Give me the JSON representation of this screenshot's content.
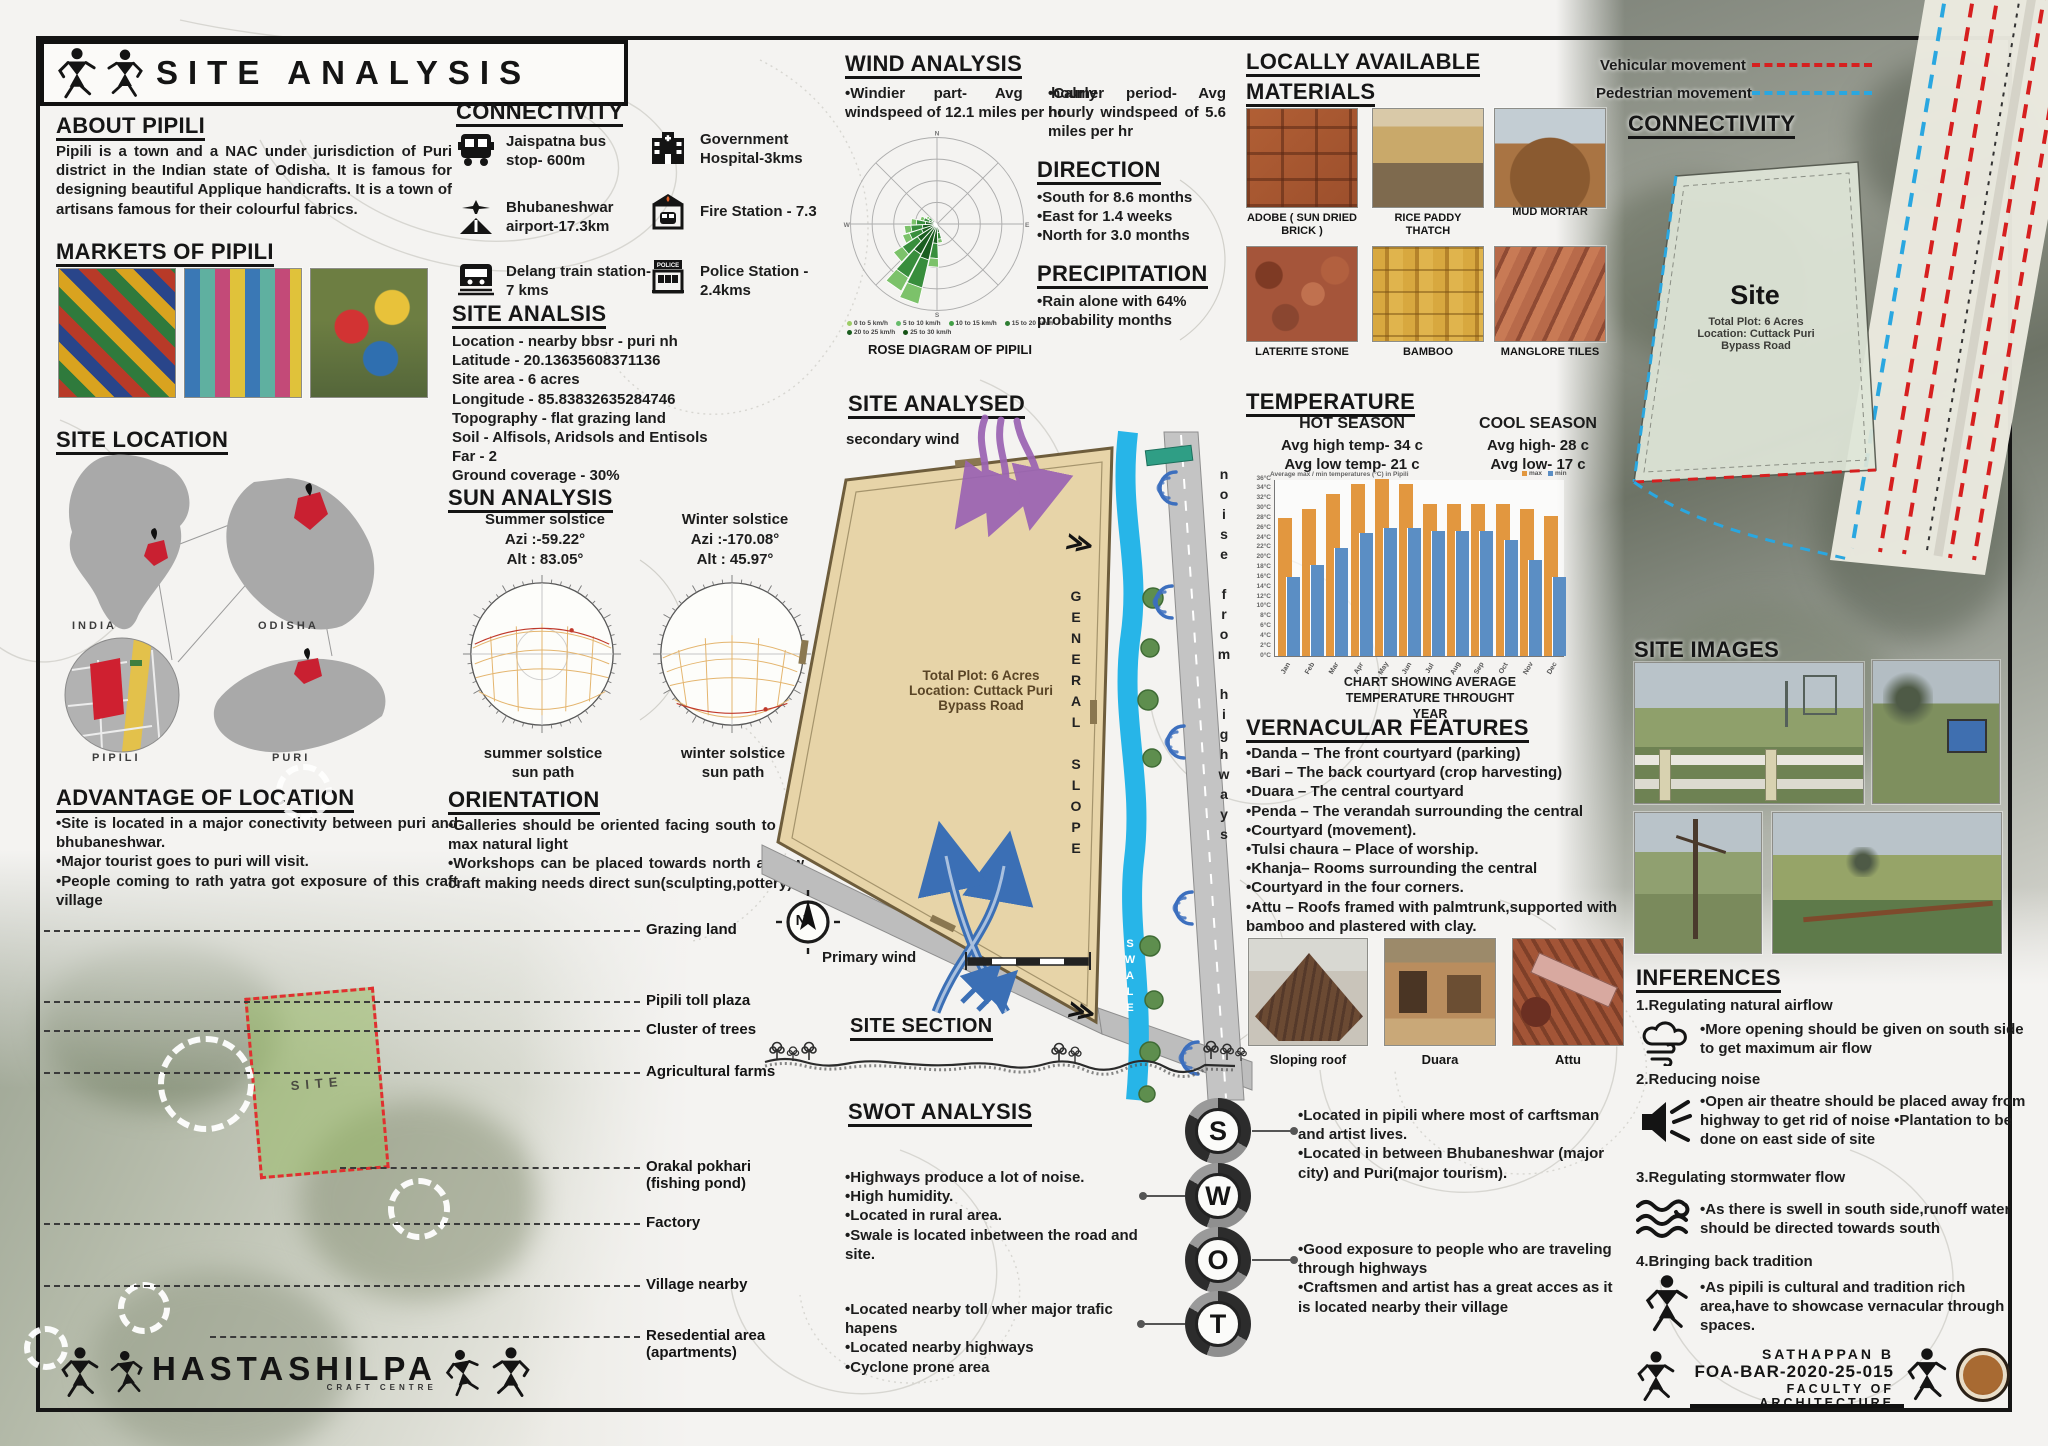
{
  "title": {
    "text": "SITE ANALYSIS"
  },
  "about": {
    "heading": "ABOUT PIPILI",
    "text": "Pipili is a town and a NAC under jurisdiction of Puri district in the Indian state of Odisha. It is famous for designing beautiful Applique handicrafts. It is a town of artisans famous for their colourful fabrics."
  },
  "markets": {
    "heading": "MARKETS OF PIPILI"
  },
  "site_location": {
    "heading": "SITE LOCATION",
    "india": "INDIA",
    "odisha": "ODISHA",
    "pipili": "PIPILI",
    "puri": "PURI"
  },
  "advantage": {
    "heading": "ADVANTAGE OF LOCATION",
    "items": [
      "•Site is located in a major conectivity between puri and bhubaneshwar.",
      "•Major tourist goes to puri will visit.",
      "•People coming to rath yatra got exposure of this craft village"
    ]
  },
  "aerial": {
    "site_label": "SITE",
    "callouts": [
      "Grazing land",
      "Pipili toll plaza",
      "Cluster of trees",
      "Agricultural farms",
      "Orakal pokhari\n(fishing pond)",
      "Factory",
      "Village nearby",
      "Resedential area\n(apartments)"
    ]
  },
  "connectivity": {
    "heading": "CONNECTIVITY",
    "items": [
      {
        "icon": "bus-icon",
        "label": "Jaispatna bus stop- 600m"
      },
      {
        "icon": "hospital-icon",
        "label": "Government Hospital-3kms"
      },
      {
        "icon": "airport-icon",
        "label": "Bhubaneshwar airport-17.3km"
      },
      {
        "icon": "fire-station-icon",
        "label": "Fire Station - 7.3"
      },
      {
        "icon": "train-icon",
        "label": "Delang train station- 7 kms"
      },
      {
        "icon": "police-station-icon",
        "label": "Police Station - 2.4kms"
      }
    ]
  },
  "site_analsis": {
    "heading": "SITE ANALSIS",
    "lines": [
      "Location - nearby bbsr - puri nh",
      "Latitude - 20.13635608371136",
      "Site area - 6 acres",
      "Longitude - 85.83832635284746",
      "Topography - flat grazing land",
      "Soil -  Alfisols, Aridsols and Entisols",
      "Far - 2",
      "Ground coverage - 30%"
    ]
  },
  "sun": {
    "heading": "SUN ANALYSIS",
    "summer_title": "Summer solstice",
    "summer_azi": "Azi :-59.22°",
    "summer_alt": "Alt : 83.05°",
    "winter_title": "Winter solstice",
    "winter_azi": "Azi :-170.08°",
    "winter_alt": "Alt :  45.97°",
    "summer_caption": "summer solstice\nsun path",
    "winter_caption": "winter solstice\nsun path"
  },
  "orientation": {
    "heading": "ORIENTATION",
    "items": [
      "•Galleries should be oriented facing south to get max natural light",
      "•Workshops can be placed towards north as few craft making needs direct sun(sculpting,pottery)"
    ]
  },
  "wind": {
    "heading": "WIND ANALYSIS",
    "windier": "•Windier part- Avg hourly windspeed of 12.1 miles per hr",
    "calmer": "•Calmer period- Avg hourly windspeed of 5.6 miles per hr"
  },
  "direction": {
    "heading": "DIRECTION",
    "items": [
      "•South for 8.6 months",
      "•East for 1.4 weeks",
      "•North for 3.0 months"
    ]
  },
  "precipitation": {
    "heading": "PRECIPITATION",
    "text": "•Rain alone with 64% probability months"
  },
  "site_analysed": {
    "heading": "SITE ANALYSED",
    "secondary_wind": "secondary wind",
    "primary_wind": "Primary wind",
    "plot_text": "Total Plot: 6 Acres\nLocation: Cuttack Puri\nBypass Road",
    "general_slope": "GENERAL SLOPE",
    "noise": "noise from highways",
    "swale": "SWALE",
    "compass": "N"
  },
  "site_section": {
    "heading": "SITE SECTION"
  },
  "swot": {
    "heading": "SWOT ANALYSIS",
    "letters": [
      "S",
      "W",
      "O",
      "T"
    ],
    "s_items": [
      "•Located in pipili where most of carftsman and artist lives.",
      "•Located in between Bhubaneshwar (major city) and Puri(major tourism)."
    ],
    "w_items": [
      "•Highways produce a lot of noise.",
      "•High humidity.",
      "•Located in rural area.",
      "•Swale is located inbetween the road and site."
    ],
    "o_items": [
      "•Good exposure to people who are traveling through highways",
      "•Craftsmen and artist has a great acces as it is located nearby their village"
    ],
    "t_items": [
      "•Located nearby toll wher major trafic hapens",
      "•Located nearby highways",
      "•Cyclone prone area"
    ]
  },
  "materials": {
    "heading1": "LOCALLY AVAILABLE",
    "heading2": "MATERIALS",
    "captions": [
      "ADOBE ( SUN DRIED\nBRICK )",
      "RICE PADDY\nTHATCH",
      "MUD MORTAR",
      "LATERITE STONE",
      "BAMBOO",
      "MANGLORE TILES"
    ]
  },
  "temperature": {
    "heading": "TEMPERATURE",
    "hot_title": "HOT SEASON",
    "hot_high": "Avg high temp- 34 c",
    "hot_low": "Avg low temp- 21 c",
    "cool_title": "COOL SEASON",
    "cool_high": "Avg high- 28 c",
    "cool_low": "Avg low- 17 c",
    "caption": "CHART SHOWING AVERAGE\nTEMPERATURE THROUGHT YEAR"
  },
  "vernacular": {
    "heading": "VERNACULAR FEATURES",
    "items": [
      "•Danda – The front courtyard (parking)",
      "•Bari – The back courtyard (crop harvesting)",
      "•Duara – The central courtyard",
      "•Penda – The verandah surrounding the central",
      "•Courtyard (movement).",
      "•Tulsi chaura – Place of worship.",
      "•Khanja– Rooms surrounding the central",
      "•Courtyard in the four corners.",
      "•Attu – Roofs framed with palmtrunk,supported with bamboo and plastered with clay."
    ],
    "captions": [
      "Sloping roof",
      "Duara",
      "Attu"
    ]
  },
  "movement_legend": {
    "vehicular": "Vehicular movement",
    "pedestrian": "Pedestrian movement",
    "vehicular_color": "#d61f1f",
    "pedestrian_color": "#2aa7e0"
  },
  "connectivity_right": {
    "heading": "CONNECTIVITY",
    "site_title": "Site",
    "site_sub": "Total Plot: 6 Acres\nLocation: Cuttack Puri\nBypass Road"
  },
  "site_images": {
    "heading": "SITE IMAGES"
  },
  "inferences": {
    "heading": "INFERENCES",
    "groups": [
      {
        "title": "1.Regulating natural airflow",
        "icon": "wind-cloud-icon",
        "bullets": "•More opening should be given on south side to get maximum air flow"
      },
      {
        "title": "2.Reducing noise",
        "icon": "speaker-noise-icon",
        "bullets": "•Open air theatre should be placed away from highway to get rid of noise\n•Plantation to be done on east side of site"
      },
      {
        "title": "3.Regulating stormwater flow",
        "icon": "water-waves-icon",
        "bullets": "•As there is swell in south side,runoff water should be directed towards south"
      },
      {
        "title": "4.Bringing back tradition",
        "icon": "tribal-figure-icon",
        "bullets": "•As pipili is cultural and tradition rich area,have to showcase vernacular through spaces."
      }
    ]
  },
  "footer": {
    "brand": "HASTASHILPA",
    "brand_sub": "CRAFT CENTRE",
    "author": "SATHAPPAN B",
    "code": "FOA-BAR-2020-25-015",
    "faculty": "FACULTY OF ARCHITECTURE"
  },
  "chart_data": [
    {
      "id": "temperature-chart",
      "type": "bar",
      "title": "Average max / min temperatures (°C) in Pipili",
      "categories": [
        "Jan",
        "Feb",
        "Mar",
        "Apr",
        "May",
        "Jun",
        "Jul",
        "Aug",
        "Sep",
        "Oct",
        "Nov",
        "Dec"
      ],
      "series": [
        {
          "name": "max",
          "color": "#e2973f",
          "values": [
            28,
            30,
            33,
            35,
            36,
            35,
            31,
            31,
            31,
            31,
            30,
            28.5
          ]
        },
        {
          "name": "min",
          "color": "#5b8ec4",
          "values": [
            16,
            18.5,
            22,
            25,
            26,
            26,
            25.5,
            25.5,
            25.5,
            23.5,
            19.5,
            16
          ]
        }
      ],
      "ylim": [
        0,
        36
      ],
      "ytick_step": 2,
      "grid": false,
      "legend_position": "top-right",
      "caption": "CHART SHOWING AVERAGE\nTEMPERATURE THROUGHT YEAR"
    },
    {
      "id": "wind-rose",
      "type": "wind-rose",
      "caption": "ROSE DIAGRAM OF PIPILI",
      "legend": [
        "0 to 5 km/h",
        "5 to 10 km/h",
        "10 to 15 km/h",
        "15 to 20 km/h",
        "20 to 25 km/h",
        "25 to 30 km/h"
      ],
      "legend_colors": [
        "#9ccc65",
        "#66bb6a",
        "#43a047",
        "#2e7d32",
        "#1b5e20",
        "#145214"
      ],
      "petal_colors": [
        "#1b5e20",
        "#388e3c",
        "#7cc26a"
      ],
      "petals": [
        {
          "dir": 170,
          "len": 0.22
        },
        {
          "dir": 185,
          "len": 0.5
        },
        {
          "dir": 200,
          "len": 0.95
        },
        {
          "dir": 215,
          "len": 0.88
        },
        {
          "dir": 230,
          "len": 0.6
        },
        {
          "dir": 245,
          "len": 0.42
        },
        {
          "dir": 260,
          "len": 0.38
        },
        {
          "dir": 275,
          "len": 0.3
        },
        {
          "dir": 290,
          "len": 0.2
        },
        {
          "dir": 305,
          "len": 0.14
        }
      ]
    }
  ]
}
